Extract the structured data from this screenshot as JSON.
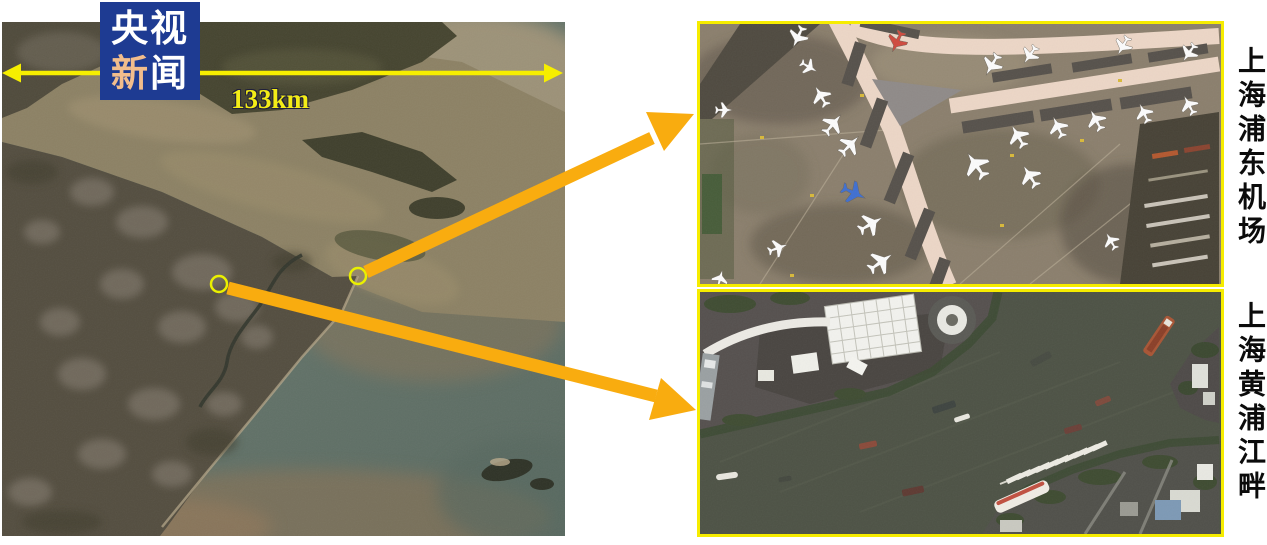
{
  "branding": {
    "name": "央视新闻",
    "line1": "央视",
    "line2_highlight": "新",
    "line2_rest": "闻"
  },
  "main_map": {
    "scale_label": "133km"
  },
  "insets": {
    "airport": {
      "label": "上海浦东机场"
    },
    "river": {
      "label": "上海黄浦江畔"
    }
  },
  "icons": {
    "scale_arrow": "double-headed-arrow-icon",
    "poi_marker": "circle-marker-icon",
    "callout_arrow": "arrow-icon",
    "airplane": "airplane-icon",
    "ship": "ship-icon"
  },
  "colors": {
    "logo_blue": "#1e3b92",
    "logo_highlight": "#f2bd8c",
    "scale_yellow": "#f3ec17",
    "arrow_yellow": "#f6ee00",
    "callout_orange": "#f9ac0f",
    "panel_border_yellow": "#f6ec00",
    "marker_yellow": "#eaf000"
  }
}
